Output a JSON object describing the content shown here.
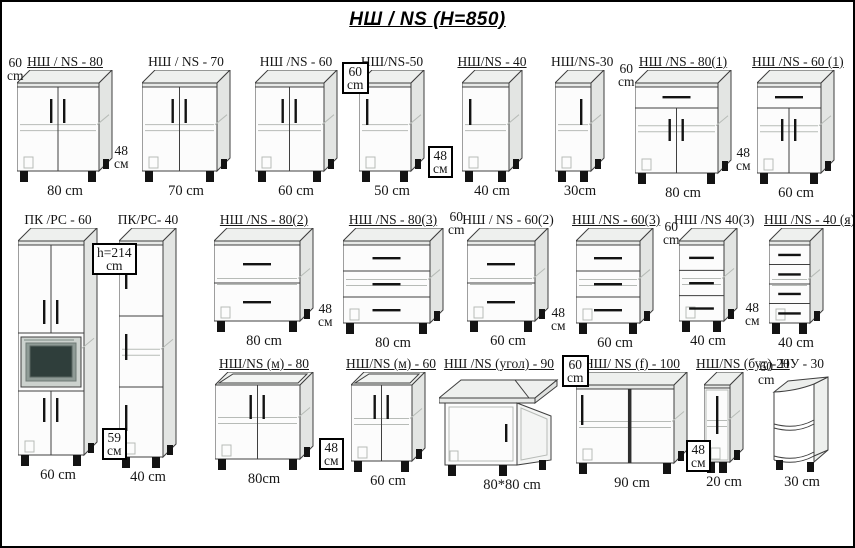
{
  "page": {
    "title": "НШ / NS  (H=850)"
  },
  "colors": {
    "line": "#3f3f3f",
    "light_line": "#b7bbb7",
    "dark": "#131313",
    "top_face": "#eef0ee",
    "side_face": "#e3e5e3",
    "front_face": "#fcfcfc",
    "slab": "#e7e9e7",
    "appliance_frame": "#ccd2ce",
    "appliance_screen": "#2f3e3b"
  },
  "cabinets": [
    {
      "id": "ns-80",
      "label": "НШ / NS - 80",
      "dim": "80 cm",
      "type": "doors2",
      "underline": true
    },
    {
      "id": "ns-70",
      "label": "НШ / NS - 70",
      "dim": "70 cm",
      "type": "doors2",
      "underline": false
    },
    {
      "id": "ns-60",
      "label": "НШ /NS - 60",
      "dim": "60 cm",
      "type": "doors2",
      "underline": false
    },
    {
      "id": "ns-50",
      "label": "НШ/NS-50",
      "dim": "50 cm",
      "type": "door1",
      "underline": false
    },
    {
      "id": "ns-40",
      "label": "НШ/NS - 40",
      "dim": "40 cm",
      "type": "door1",
      "underline": true
    },
    {
      "id": "ns-30",
      "label": "НШ/NS-30",
      "dim": "30cm",
      "type": "door1",
      "underline": false
    },
    {
      "id": "ns-80-1",
      "label": "НШ /NS - 80(1)",
      "dim": "80 cm",
      "type": "drawerDoors",
      "underline": true
    },
    {
      "id": "ns-60-1",
      "label": "НШ /NS - 60 (1)",
      "dim": "60 cm",
      "type": "drawerDoors",
      "underline": true
    },
    {
      "id": "pk-rs-60",
      "label": "ПК /РС - 60",
      "dim": "60 cm",
      "type": "tallMicro",
      "underline": false
    },
    {
      "id": "pk-rs-40",
      "label": "ПК/РС- 40",
      "dim": "40 cm",
      "type": "tall3",
      "underline": false
    },
    {
      "id": "ns-80-2",
      "label": "НШ /NS - 80(2)",
      "dim": "80 cm",
      "type": "drawers2",
      "underline": true
    },
    {
      "id": "ns-80-3",
      "label": "НШ /NS - 80(3)",
      "dim": "80 cm",
      "type": "drawers3",
      "underline": true
    },
    {
      "id": "ns-60-2",
      "label": "НШ / NS - 60(2)",
      "dim": "60 cm",
      "type": "drawers2",
      "underline": false
    },
    {
      "id": "ns-60-3",
      "label": "НШ /NS - 60(3)",
      "dim": "60 cm",
      "type": "drawers3",
      "underline": true
    },
    {
      "id": "ns-40-3",
      "label": "НШ /NS 40(3)",
      "dim": "40 cm",
      "type": "drawers3",
      "underline": false
    },
    {
      "id": "ns-40-ya",
      "label": "НШ /NS - 40 (я)",
      "dim": "40 cm",
      "type": "drawers4",
      "underline": true
    },
    {
      "id": "ns-m-80",
      "label": "НШ/NS (м) - 80",
      "dim": "80cm",
      "type": "sink",
      "underline": true
    },
    {
      "id": "ns-m-60",
      "label": "НШ/NS (м) - 60",
      "dim": "60 cm",
      "type": "sink",
      "underline": true
    },
    {
      "id": "ns-ugol-90",
      "label": "НШ /NS (угол) - 90",
      "dim": "80*80 cm",
      "type": "corner",
      "underline": true
    },
    {
      "id": "ns-f-100",
      "label": "НШ/ NS (f) - 100",
      "dim": "90 cm",
      "type": "wideF",
      "underline": true
    },
    {
      "id": "ns-but-20",
      "label": "НШ/NS (бут)-20",
      "dim": "20 cm",
      "type": "narrow",
      "underline": true
    },
    {
      "id": "nu-30",
      "label": "НУ - 30",
      "dim": "30 cm",
      "type": "openShelf",
      "underline": false
    }
  ],
  "annotations": [
    {
      "line1": "60",
      "line2": "cm",
      "boxed": false
    },
    {
      "line1": "48",
      "line2": "см",
      "boxed": false
    },
    {
      "line1": "60",
      "line2": "cm",
      "boxed": true
    },
    {
      "line1": "48",
      "line2": "см",
      "boxed": true
    },
    {
      "line1": "60",
      "line2": "cm",
      "boxed": false
    },
    {
      "line1": "48",
      "line2": "см",
      "boxed": false
    },
    {
      "line1": "h=214",
      "line2": "cm",
      "boxed": true
    },
    {
      "line1": "59",
      "line2": "см",
      "boxed": true
    },
    {
      "line1": "48",
      "line2": "см",
      "boxed": false
    },
    {
      "line1": "60",
      "line2": "cm",
      "boxed": false
    },
    {
      "line1": "48",
      "line2": "см",
      "boxed": false
    },
    {
      "line1": "60",
      "line2": "cm",
      "boxed": false
    },
    {
      "line1": "48",
      "line2": "см",
      "boxed": false
    },
    {
      "line1": "48",
      "line2": "см",
      "boxed": true
    },
    {
      "line1": "60",
      "line2": "cm",
      "boxed": true
    },
    {
      "line1": "48",
      "line2": "см",
      "boxed": true
    },
    {
      "line1": "60",
      "line2": "cm",
      "boxed": false
    }
  ]
}
